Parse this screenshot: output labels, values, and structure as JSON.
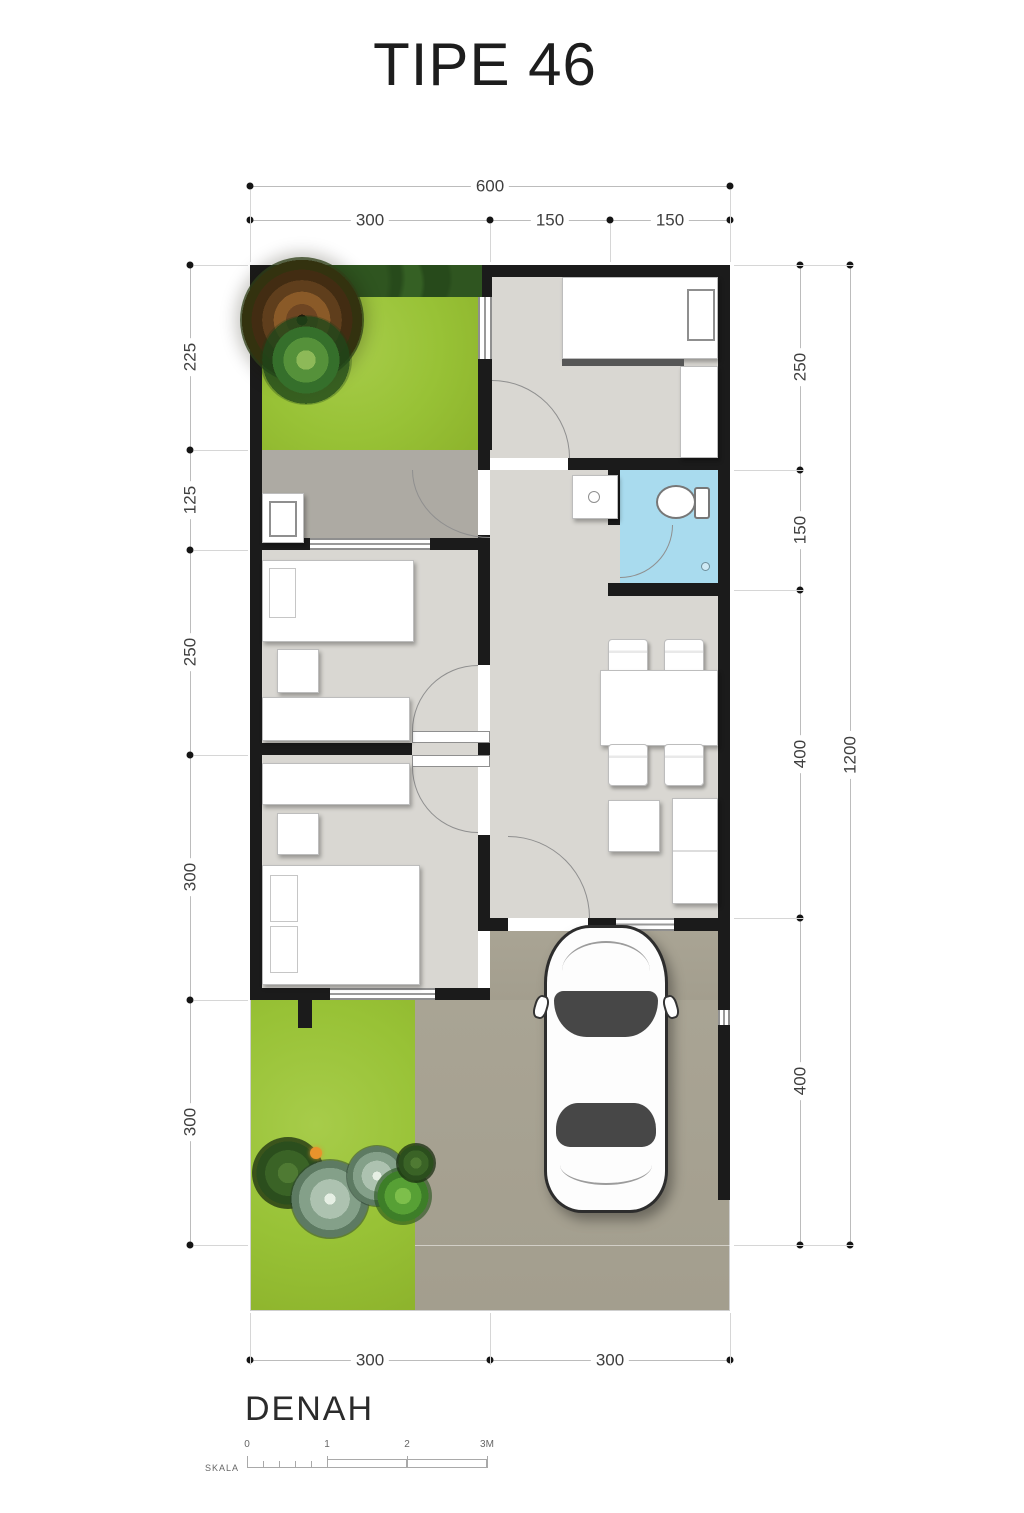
{
  "title": "TIPE 46",
  "plan_label": "DENAH",
  "scale_bar": {
    "label": "SKALA",
    "ticks": [
      "0",
      "1",
      "2",
      "3M"
    ]
  },
  "dimensions": {
    "top": {
      "total": "600",
      "segments": [
        "300",
        "150",
        "150"
      ]
    },
    "left": {
      "segments": [
        "225",
        "125",
        "250",
        "300",
        "300"
      ]
    },
    "right": {
      "segments": [
        "250",
        "150",
        "400",
        "400"
      ],
      "total": "1200"
    },
    "bottom": {
      "segments": [
        "300",
        "300"
      ]
    }
  },
  "colors": {
    "wall": "#1b1b1b",
    "floor": "#d9d7d2",
    "floor_service": "#adaaa3",
    "grass": "#9cc23c",
    "bathroom": "#a9dbee",
    "driveway": "#a8a393",
    "dim_text": "#3f3f3f",
    "dim_line": "#bcbcbc",
    "title_text": "#1d1d1d"
  }
}
